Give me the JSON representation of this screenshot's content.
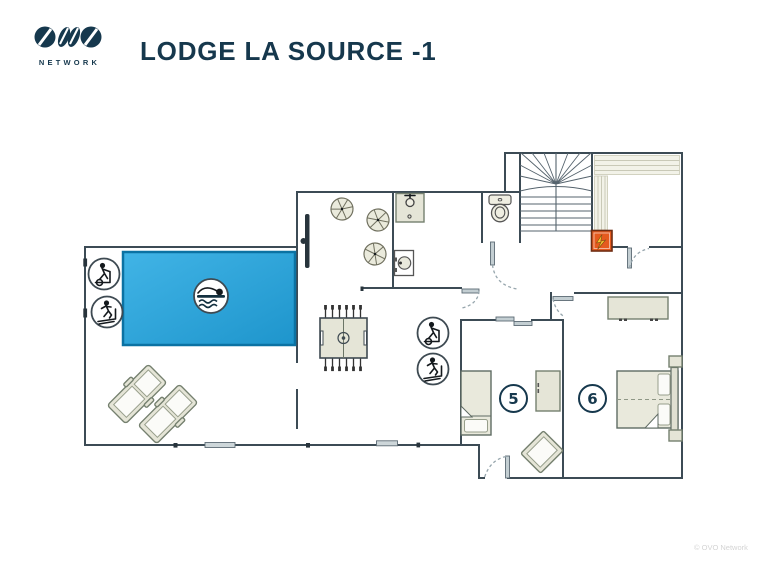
{
  "header": {
    "logo_text": "NETWORK",
    "title": "LODGE LA SOURCE -1"
  },
  "footer": {
    "copyright": "© OVO Network"
  },
  "plan": {
    "floor": "-1",
    "rooms": [
      {
        "name": "pool-room",
        "features": [
          "swimming-pool",
          "swimmer-icon",
          "elliptical-trainer-icon",
          "treadmill-icon",
          "sun-loungers"
        ]
      },
      {
        "name": "games-area",
        "features": [
          "foosball-table",
          "elliptical-trainer-icon",
          "treadmill-icon"
        ]
      },
      {
        "name": "laundry-room",
        "features": [
          "utility-sink",
          "washing-machine",
          "plant",
          "plant",
          "plant"
        ]
      },
      {
        "name": "wc",
        "features": [
          "toilet"
        ]
      },
      {
        "name": "stairwell",
        "features": [
          "winder-staircase"
        ]
      },
      {
        "name": "storage-room",
        "features": [
          "shelving",
          "electrical-panel-icon"
        ]
      },
      {
        "name": "bedroom-5",
        "label": "5",
        "features": [
          "single-bed",
          "wardrobe",
          "armchair"
        ]
      },
      {
        "name": "bedroom-6",
        "label": "6",
        "features": [
          "double-bed",
          "wardrobe",
          "nightstand",
          "nightstand"
        ]
      }
    ]
  },
  "icons": {
    "swimmer": "swimmer-icon",
    "elliptical": "elliptical-trainer-icon",
    "treadmill": "treadmill-icon",
    "electrical": "electrical-panel-icon"
  },
  "colors": {
    "navy": "#16384d",
    "wall": "#3c4b55",
    "pool-fill": "#2ba5dc",
    "pool-border": "#0b72a3",
    "furniture-fill": "#e5e5d7",
    "furniture-stroke": "#75806f",
    "panel-orange": "#e55a1e",
    "bolt-yellow": "#f6c52e",
    "copyright-gray": "#d4d4d4"
  }
}
